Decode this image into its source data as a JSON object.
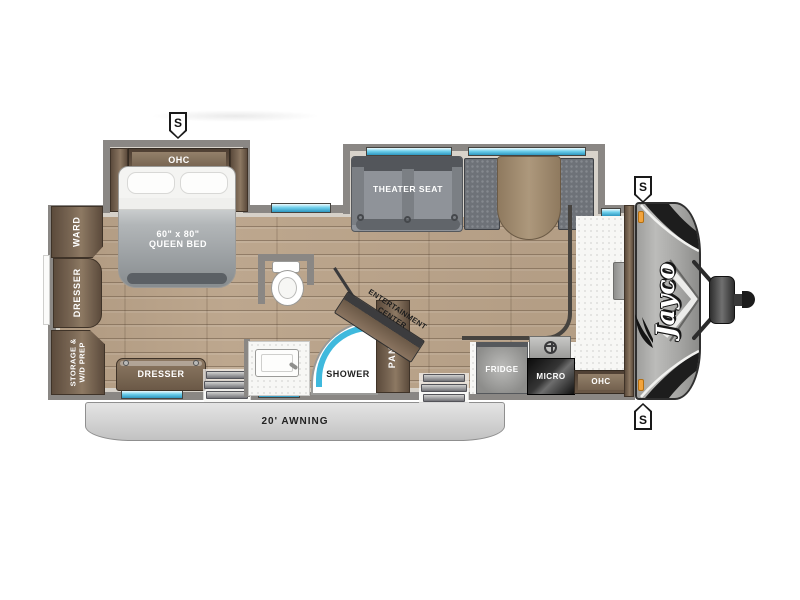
{
  "floorplan": {
    "brand_logo": "Jayco",
    "awning": "20' AWNING",
    "speaker": "S",
    "bedroom": {
      "ohc": "OHC",
      "bed_size": "60\" x 80\"",
      "bed_name": "QUEEN BED",
      "ward": "WARD",
      "dresser_side": "DRESSER",
      "storage_line1": "STORAGE &",
      "storage_line2": "W/D PREP",
      "dresser_front": "DRESSER"
    },
    "living": {
      "theater_seat": "THEATER SEAT",
      "entertainment_line1": "ENTERTAINMENT",
      "entertainment_line2": "CENTER"
    },
    "bath": {
      "shower": "SHOWER"
    },
    "kitchen": {
      "pantry": "PANTRY",
      "fridge": "FRIDGE",
      "micro": "MICRO",
      "ohc": "OHC"
    },
    "colors": {
      "floor_wood": "#bda78e",
      "wall_gray": "#8a8784",
      "cabinet_brown": "#6f5d4a",
      "window_cyan": "#5ec9e8",
      "awning_gray": "#c9c9c9",
      "marker_orange": "#f2a33c"
    }
  }
}
